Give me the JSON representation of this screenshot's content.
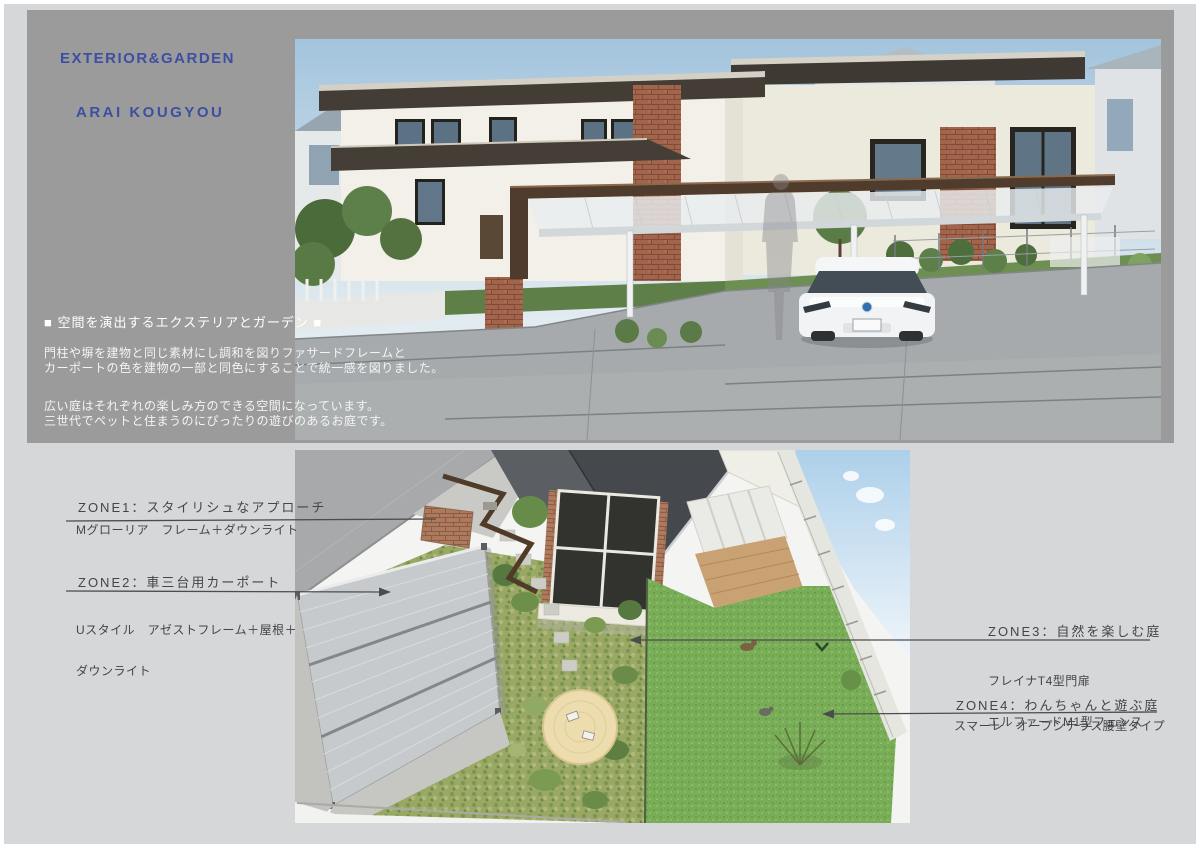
{
  "header": {
    "line1": "EXTERIOR&GARDEN",
    "line2": "ARAI KOUGYOU"
  },
  "hero": {
    "heading": "■ 空間を演出するエクステリアとガーデン ■",
    "p1_line1": "門柱や塀を建物と同じ素材にし調和を図りファサードフレームと",
    "p1_line2": "カーポートの色を建物の一部と同色にすることで統一感を図りました。",
    "p2_line1": "広い庭はそれぞれの楽しみ方のできる空間になっています。",
    "p2_line2": "三世代でペットと住まうのにぴったりの遊びのあるお庭です。"
  },
  "zones": [
    {
      "title": "ZONE1：スタイリシュなアプローチ",
      "details": [
        "Mグローリア　フレーム＋ダウンライト"
      ]
    },
    {
      "title": "ZONE2：車三台用カーポート",
      "details": [
        "Uスタイル　アゼストフレーム＋屋根＋",
        "ダウンライト"
      ]
    },
    {
      "title": "ZONE3：自然を楽しむ庭",
      "details": [
        "フレイナT4型門扉",
        "エルファードM1型フェンス"
      ]
    },
    {
      "title": "ZONE4：わんちゃんと遊ぶ庭",
      "details": [
        "スマーレ　オープンテラス腰壁タイプ"
      ]
    }
  ],
  "colors": {
    "page_background": "#d6d7d8",
    "hero_panel": "#9b9b9c",
    "brand_blue": "#3d4fa0",
    "hero_text": "#ffffff",
    "zone_text": "#454547",
    "leader_line": "#4c4c4e",
    "lawn_green": "#79ad58",
    "carport_beam_brown": "#503c2c"
  }
}
